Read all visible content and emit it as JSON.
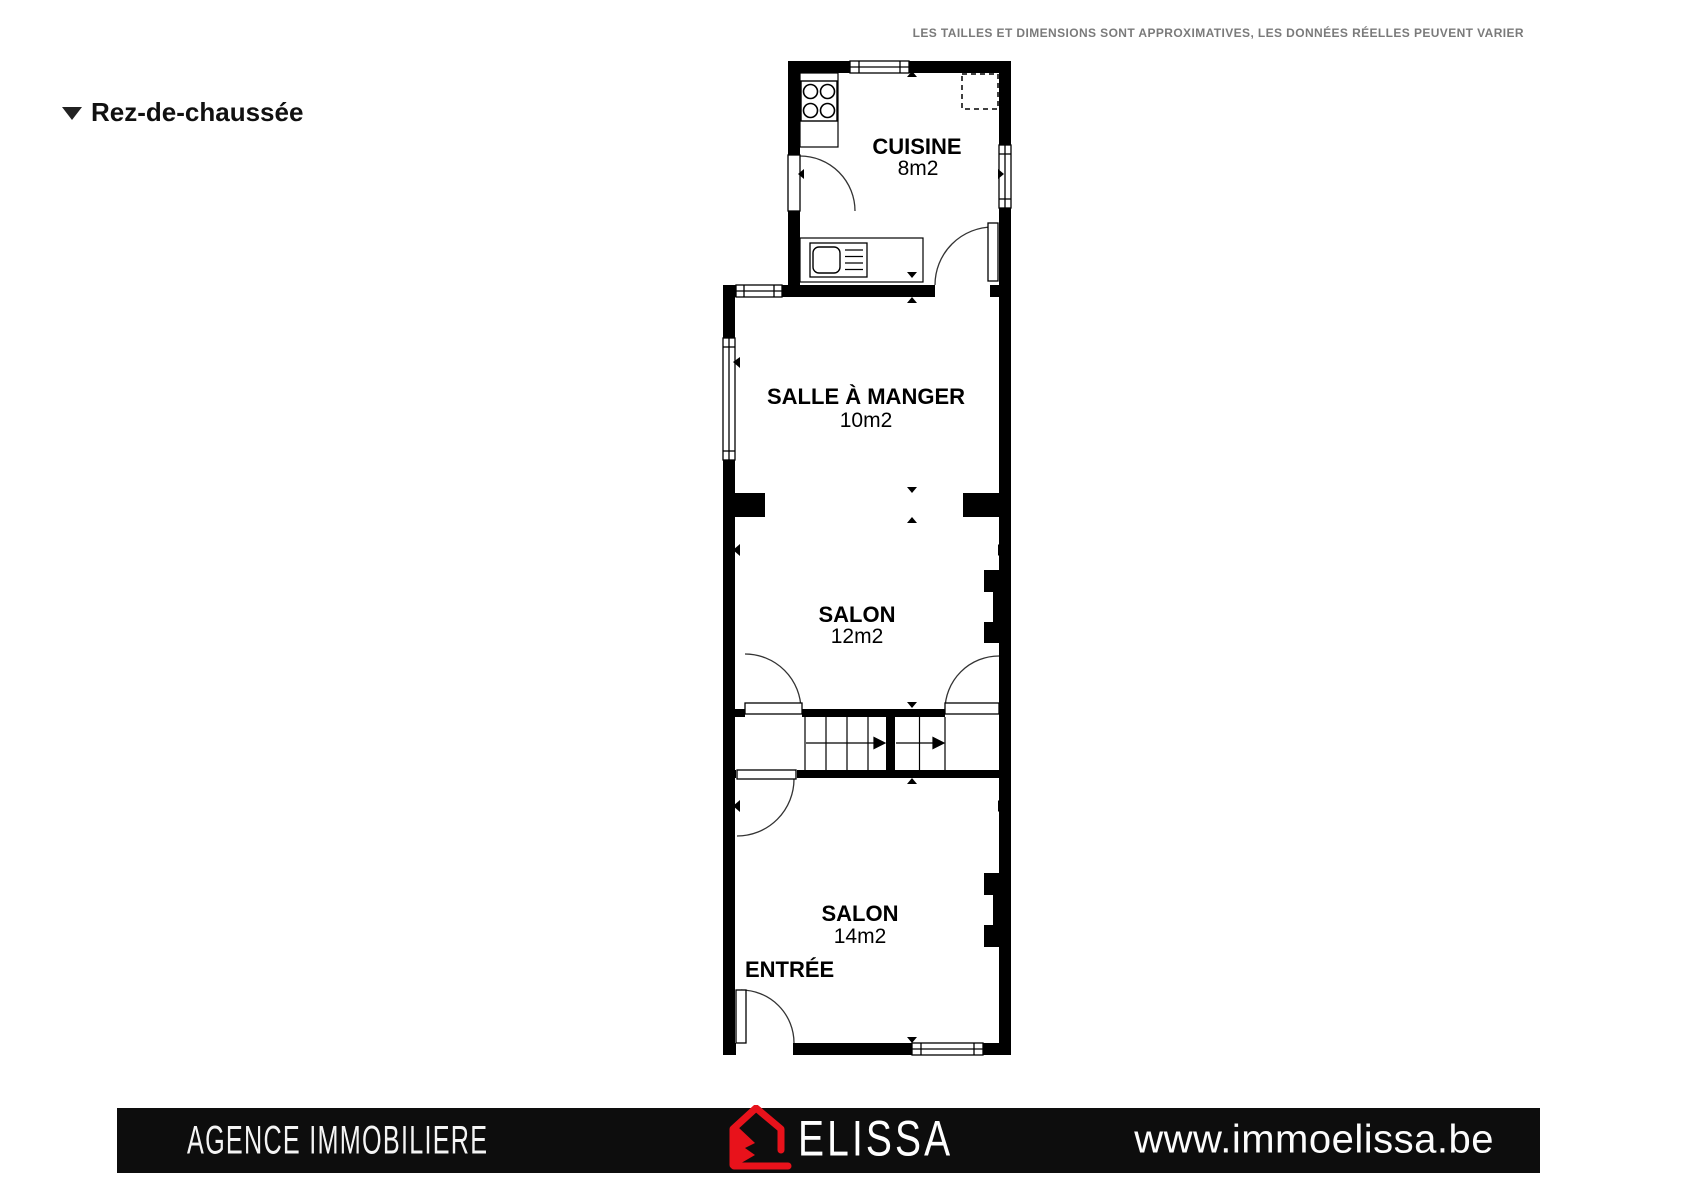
{
  "header": {
    "disclaimer": "LES TAILLES ET DIMENSIONS SONT APPROXIMATIVES, LES DONNÉES RÉELLES PEUVENT VARIER",
    "floor_label": "Rez-de-chaussée"
  },
  "plan": {
    "rooms": [
      {
        "name": "CUISINE",
        "area": "8m2"
      },
      {
        "name": "SALLE À MANGER",
        "area": "10m2"
      },
      {
        "name": "SALON",
        "area": "12m2"
      },
      {
        "name": "SALON",
        "area": "14m2"
      },
      {
        "name": "ENTRÉE",
        "area": ""
      }
    ]
  },
  "footer": {
    "agency": "AGENCE IMMOBILIERE",
    "brand": "ELISSA",
    "website": "www.immoelissa.be"
  },
  "colors": {
    "brand_red": "#e8121b",
    "wall_black": "#000000",
    "disclaimer_gray": "#7a7a7a"
  }
}
